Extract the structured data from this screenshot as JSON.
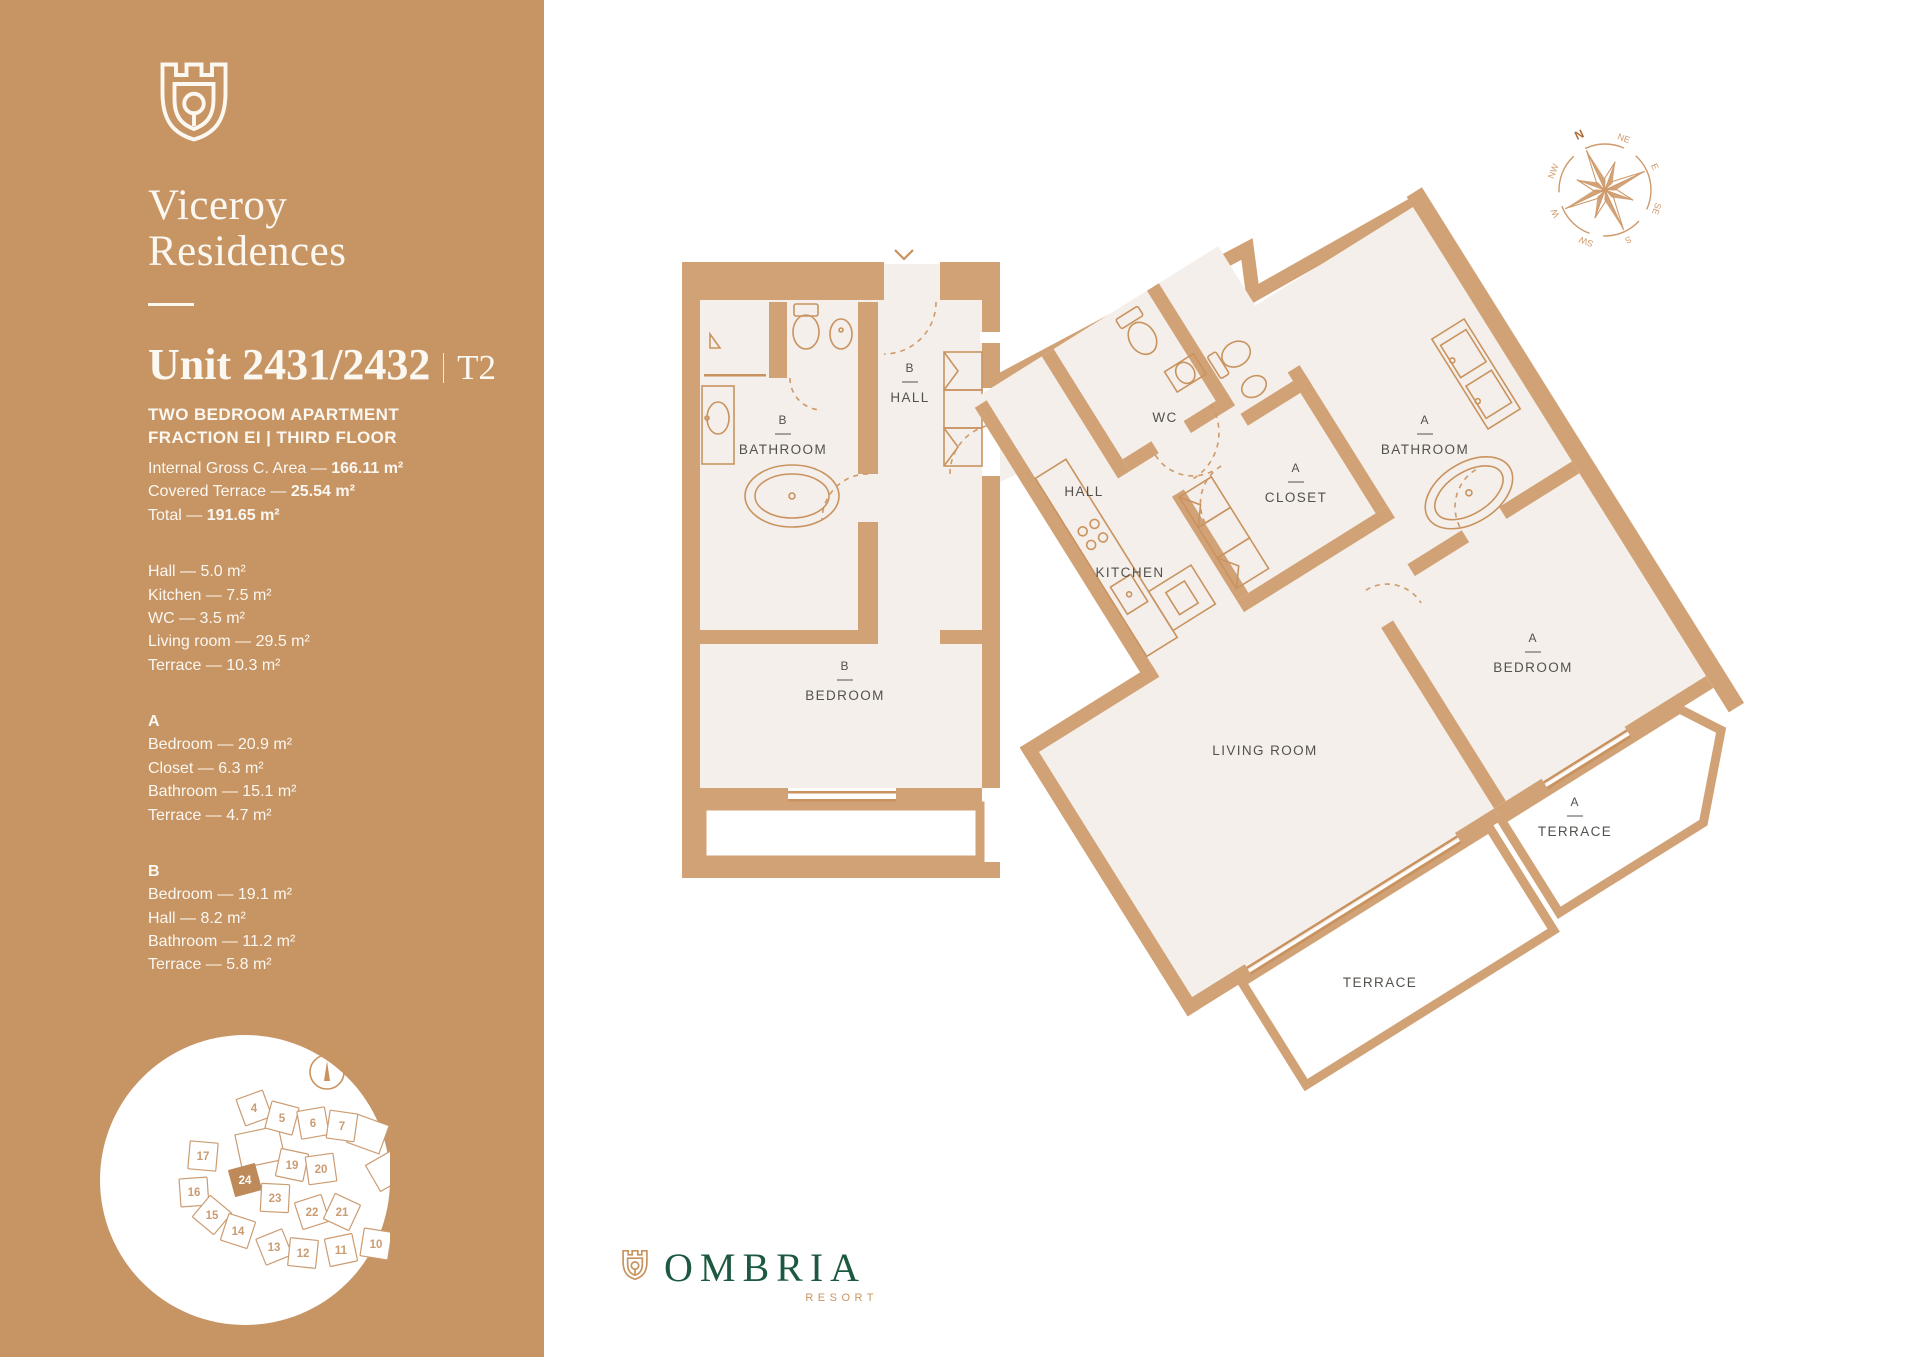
{
  "brand": {
    "name_line1": "Viceroy",
    "name_line2": "Residences",
    "footer_logo": "OMBRIA",
    "footer_sub": "RESORT"
  },
  "header": {
    "unit_title": "Unit 2431/2432",
    "unit_type": "T2",
    "subtitle_line1": "TWO BEDROOM APARTMENT",
    "subtitle_line2": "FRACTION EI  |  THIRD FLOOR"
  },
  "areas": [
    {
      "label": "Internal Gross C. Area",
      "value": "166.11 m²"
    },
    {
      "label": "Covered Terrace",
      "value": "25.54 m²"
    },
    {
      "label": "Total",
      "value": "191.65 m²"
    }
  ],
  "rooms_common": [
    {
      "label": "Hall",
      "value": "5.0 m²"
    },
    {
      "label": "Kitchen",
      "value": "7.5 m²"
    },
    {
      "label": "WC",
      "value": "3.5 m²"
    },
    {
      "label": "Living room",
      "value": "29.5 m²"
    },
    {
      "label": "Terrace",
      "value": "10.3 m²"
    }
  ],
  "section_a": {
    "header": "A",
    "items": [
      {
        "label": "Bedroom",
        "value": "20.9 m²"
      },
      {
        "label": "Closet",
        "value": "6.3 m²"
      },
      {
        "label": "Bathroom",
        "value": "15.1 m²"
      },
      {
        "label": "Terrace",
        "value": "4.7 m²"
      }
    ]
  },
  "section_b": {
    "header": "B",
    "items": [
      {
        "label": "Bedroom",
        "value": "19.1 m²"
      },
      {
        "label": "Hall",
        "value": "8.2 m²"
      },
      {
        "label": "Bathroom",
        "value": "11.2 m²"
      },
      {
        "label": "Terrace",
        "value": "5.8 m²"
      }
    ]
  },
  "plan": {
    "rooms": [
      {
        "letter": "B",
        "name": "BATHROOM"
      },
      {
        "letter": "B",
        "name": "HALL"
      },
      {
        "letter": "B",
        "name": "BEDROOM"
      },
      {
        "letter": "",
        "name": "WC"
      },
      {
        "letter": "",
        "name": "HALL"
      },
      {
        "letter": "",
        "name": "KITCHEN"
      },
      {
        "letter": "A",
        "name": "CLOSET"
      },
      {
        "letter": "A",
        "name": "BATHROOM"
      },
      {
        "letter": "A",
        "name": "BEDROOM"
      },
      {
        "letter": "",
        "name": "LIVING ROOM"
      },
      {
        "letter": "",
        "name": "TERRACE"
      },
      {
        "letter": "A",
        "name": "TERRACE"
      }
    ]
  },
  "compass": {
    "points": [
      "N",
      "NE",
      "E",
      "SE",
      "S",
      "SW",
      "W",
      "NW"
    ]
  },
  "sitemap": {
    "highlighted_lot": "24",
    "lots": [
      {
        "n": "4",
        "x": 9,
        "y": -72,
        "r": -20
      },
      {
        "n": "5",
        "x": 37,
        "y": -62,
        "r": 15
      },
      {
        "n": "6",
        "x": 68,
        "y": -57,
        "r": -10
      },
      {
        "n": "7",
        "x": 97,
        "y": -54,
        "r": 8
      },
      {
        "n": "17",
        "x": -42,
        "y": -24,
        "r": 5
      },
      {
        "n": "19",
        "x": 47,
        "y": -15,
        "r": 12
      },
      {
        "n": "20",
        "x": 76,
        "y": -11,
        "r": -8
      },
      {
        "n": "16",
        "x": -51,
        "y": 12,
        "r": -4
      },
      {
        "n": "24",
        "x": 0,
        "y": 0,
        "r": -15,
        "hl": true
      },
      {
        "n": "23",
        "x": 30,
        "y": 18,
        "r": 3
      },
      {
        "n": "22",
        "x": 67,
        "y": 32,
        "r": -18
      },
      {
        "n": "21",
        "x": 97,
        "y": 32,
        "r": 25
      },
      {
        "n": "15",
        "x": -33,
        "y": 35,
        "r": 40
      },
      {
        "n": "14",
        "x": -7,
        "y": 51,
        "r": 18
      },
      {
        "n": "13",
        "x": 29,
        "y": 67,
        "r": -22
      },
      {
        "n": "12",
        "x": 58,
        "y": 73,
        "r": 6
      },
      {
        "n": "11",
        "x": 96,
        "y": 70,
        "r": -12
      },
      {
        "n": "10",
        "x": 131,
        "y": 64,
        "r": 9
      }
    ],
    "outline_shapes": [
      {
        "x": 15,
        "y": -33,
        "w": 44,
        "h": 34,
        "r": -12
      },
      {
        "x": 123,
        "y": -46,
        "w": 34,
        "h": 30,
        "r": 20
      },
      {
        "x": 141,
        "y": -9,
        "w": 30,
        "h": 30,
        "r": -30
      }
    ]
  },
  "colors": {
    "sidebar_tan": "#C79463",
    "wall_tan": "#D2A277",
    "floor": "#F4EFEA",
    "fixture_line": "#C9935F",
    "label_gray": "#54504C",
    "logo_green": "#1C5940"
  }
}
